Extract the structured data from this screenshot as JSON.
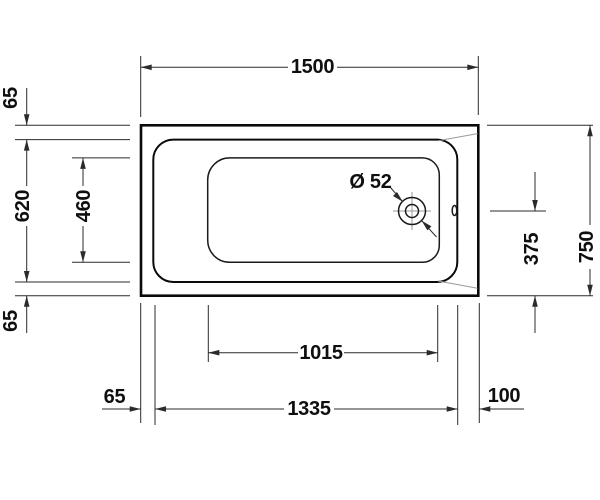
{
  "diagram": {
    "dimensions": {
      "length_overall": "1500",
      "rim_top": "65",
      "width_inner": "620",
      "width_basin": "460",
      "rim_bottom": "65",
      "width_overall": "750",
      "drain_center_offset": "375",
      "length_basin": "1015",
      "length_inner": "1335",
      "offset_left": "65",
      "offset_right": "100",
      "drain_diameter": "Ø 52"
    },
    "colors": {
      "background": "#ffffff",
      "line_heavy": "#0a0a0a",
      "line_dim": "#2b2b2b",
      "line_thin": "#9a9a9a"
    }
  }
}
